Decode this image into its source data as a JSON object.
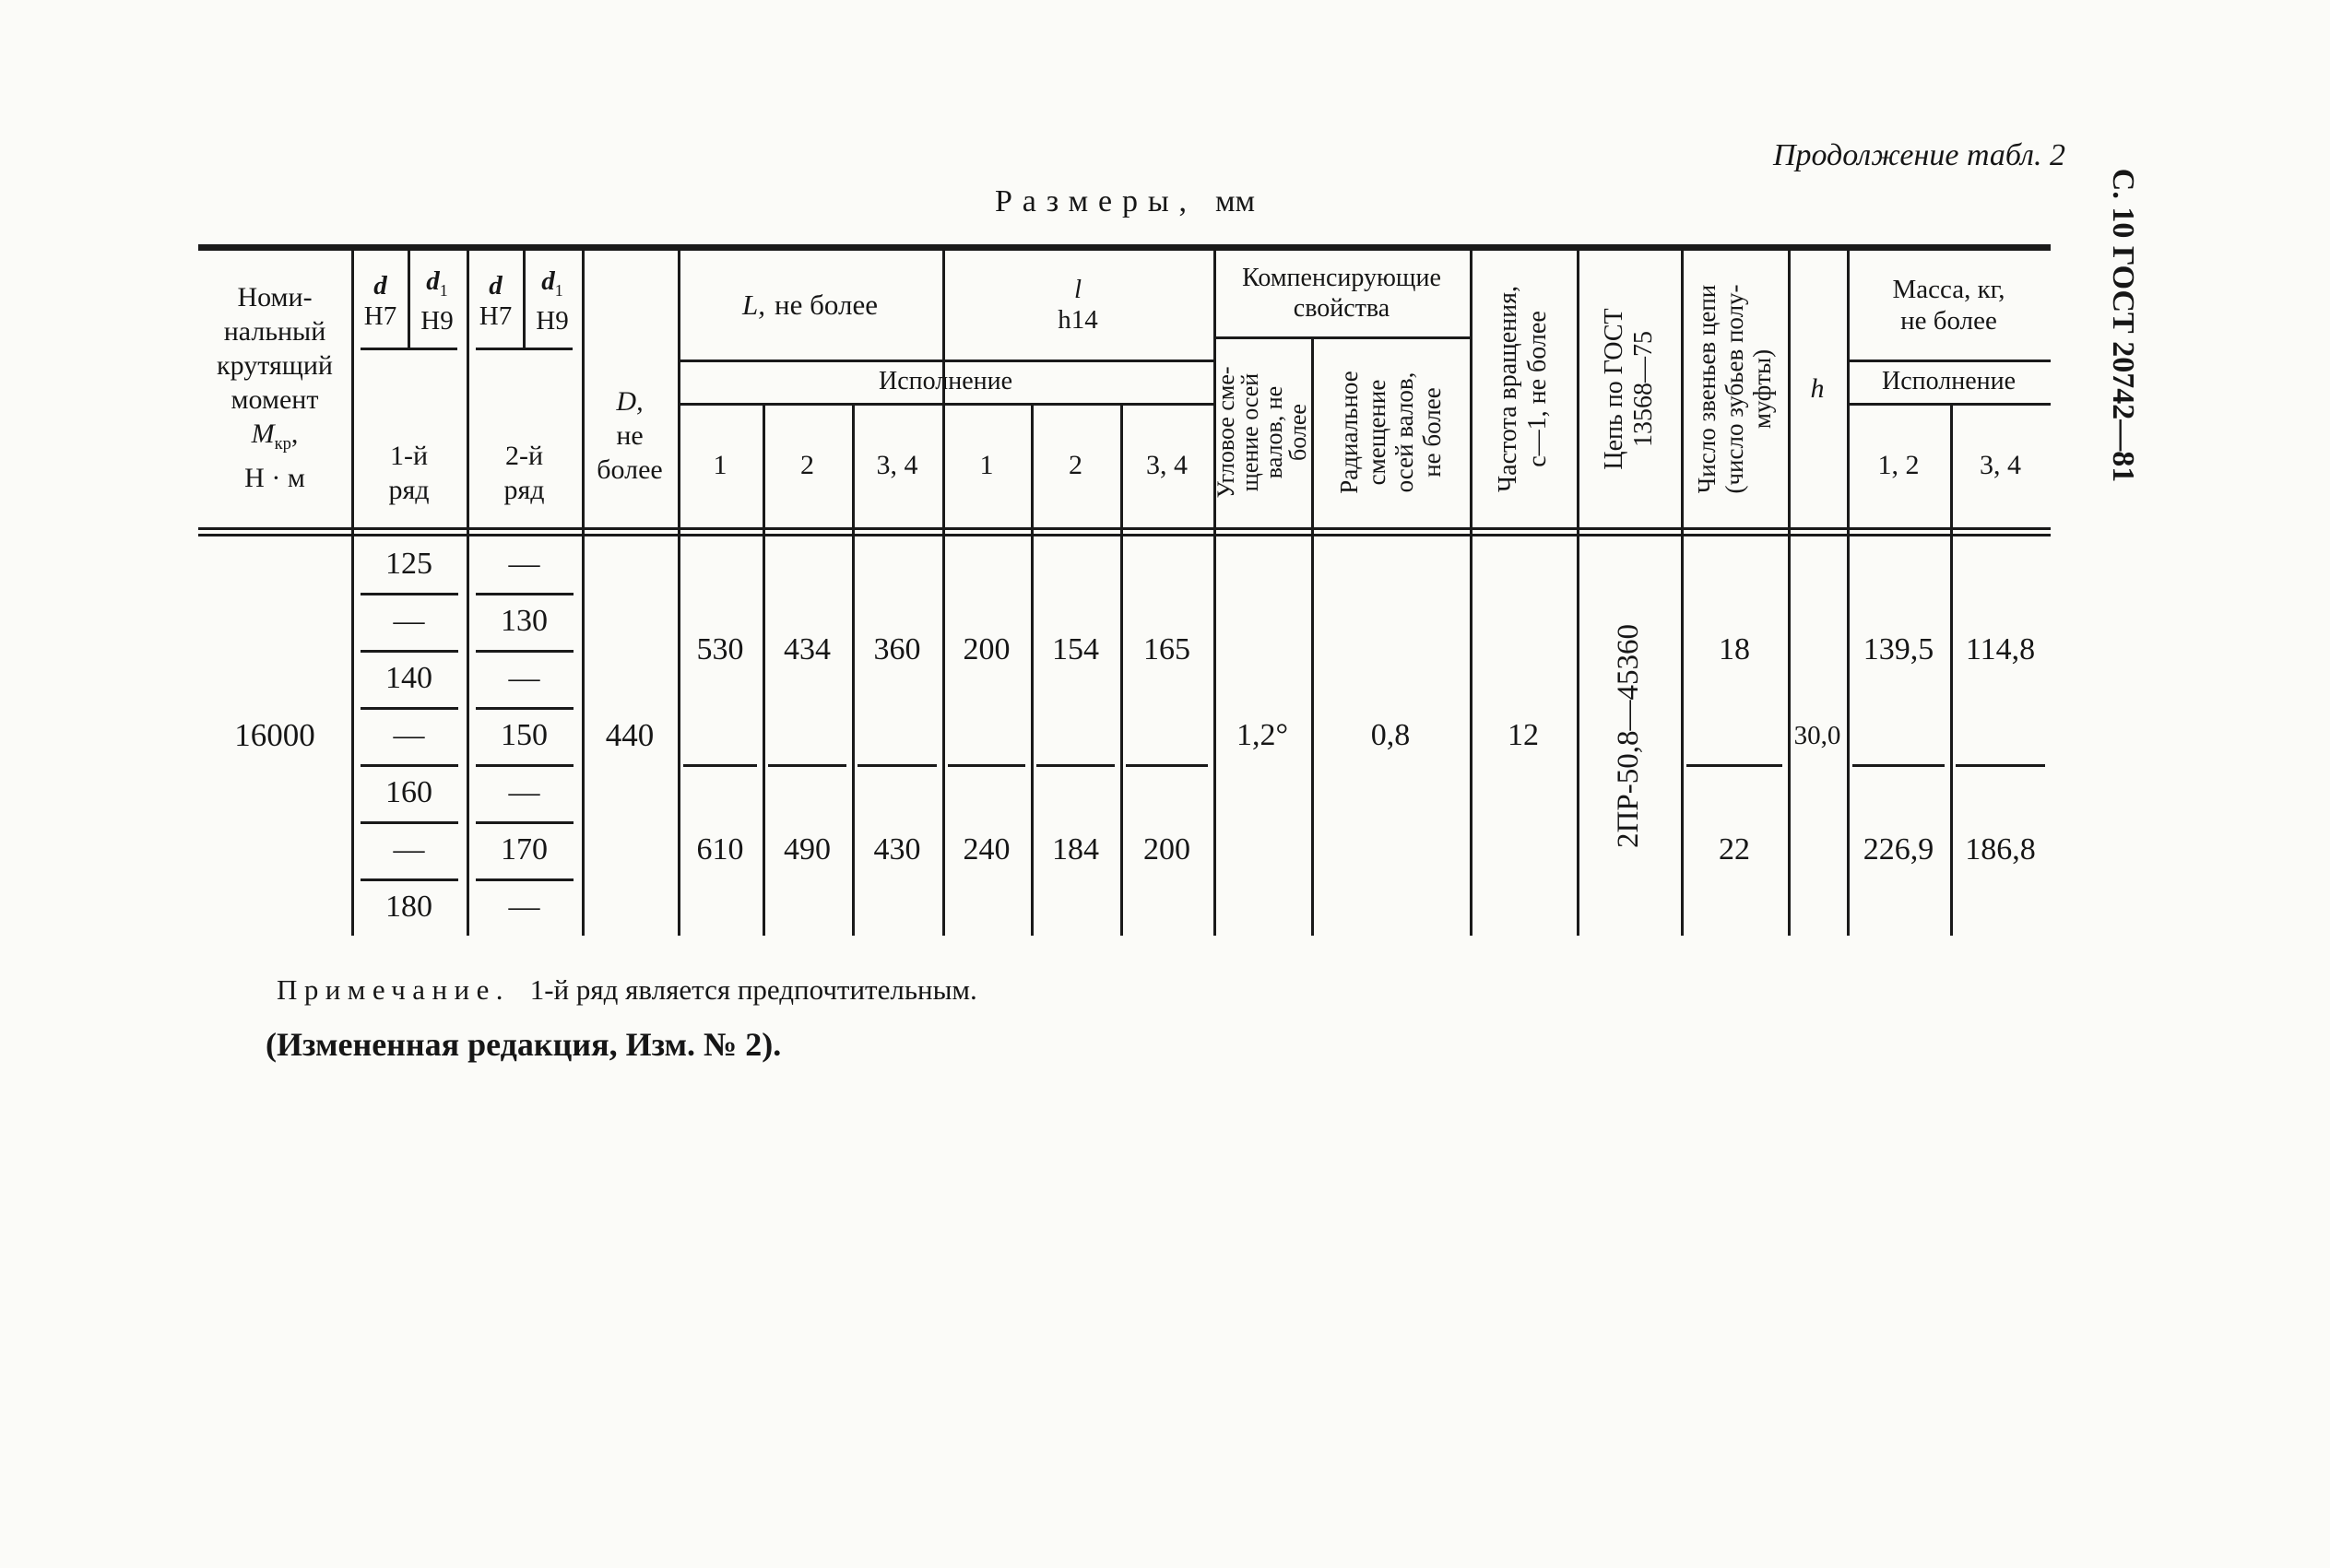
{
  "meta": {
    "continuation": "Продолжение табл. 2",
    "side_label": "С. 10 ГОСТ 20742—81",
    "title_main": "Размеры,",
    "title_units": "мм"
  },
  "header": {
    "moment": {
      "l1": "Номи-",
      "l2": "нальный",
      "l3": "крутящий",
      "l4": "момент",
      "sym": "М",
      "sub": "кр",
      "tail": ",",
      "units": "Н · м"
    },
    "fit": {
      "d": "d",
      "h7": "H7",
      "d1": "d",
      "d1sub": "1",
      "h9": "H9"
    },
    "series1": {
      "l1": "1-й",
      "l2": "ряд"
    },
    "series2": {
      "l1": "2-й",
      "l2": "ряд"
    },
    "dcol": {
      "l1": "D,",
      "l2": "не",
      "l3": "более"
    },
    "L": {
      "sym": "L,",
      "rest": "не более"
    },
    "lcol": {
      "sym": "l",
      "tol": "h14"
    },
    "ispolnenie": "Исполнение",
    "exec": [
      "1",
      "2",
      "3, 4",
      "1",
      "2",
      "3, 4"
    ],
    "comp": {
      "l1": "Компенсирующие",
      "l2": "свойства"
    },
    "angular": [
      "Угловое сме-",
      "щение осей",
      "валов, не",
      "более"
    ],
    "radial": [
      "Радиальное",
      "смещение",
      "осей валов,",
      "не более"
    ],
    "freq": [
      "Частота вращения,",
      "с—1, не более"
    ],
    "chain": [
      "Цепь по ГОСТ",
      "13568—75"
    ],
    "links": [
      "Число звеньев цепи",
      "(число зубьев полу-",
      "муфты)"
    ],
    "h": "h",
    "mass": {
      "l1": "Масса, кг,",
      "l2": "не более"
    },
    "mass_exec": [
      "1, 2",
      "3, 4"
    ]
  },
  "body": {
    "moment": "16000",
    "series1": [
      "125",
      "—",
      "140",
      "—",
      "160",
      "—",
      "180"
    ],
    "series2": [
      "—",
      "130",
      "—",
      "150",
      "—",
      "170",
      "—"
    ],
    "d": "440",
    "g1": {
      "v": [
        "530",
        "434",
        "360",
        "200",
        "154",
        "165"
      ],
      "links": "18",
      "mass1": "139,5",
      "mass2": "114,8"
    },
    "g2": {
      "v": [
        "610",
        "490",
        "430",
        "240",
        "184",
        "200"
      ],
      "links": "22",
      "mass1": "226,9",
      "mass2": "186,8"
    },
    "angular": "1,2°",
    "radial": "0,8",
    "freq": "12",
    "chain": "2ПР-50,8—45360",
    "h": "30,0"
  },
  "notes": {
    "label": "Примечание.",
    "text": "1-й ряд является предпочтительным.",
    "revision": "(Измененная редакция, Изм. № 2)."
  }
}
